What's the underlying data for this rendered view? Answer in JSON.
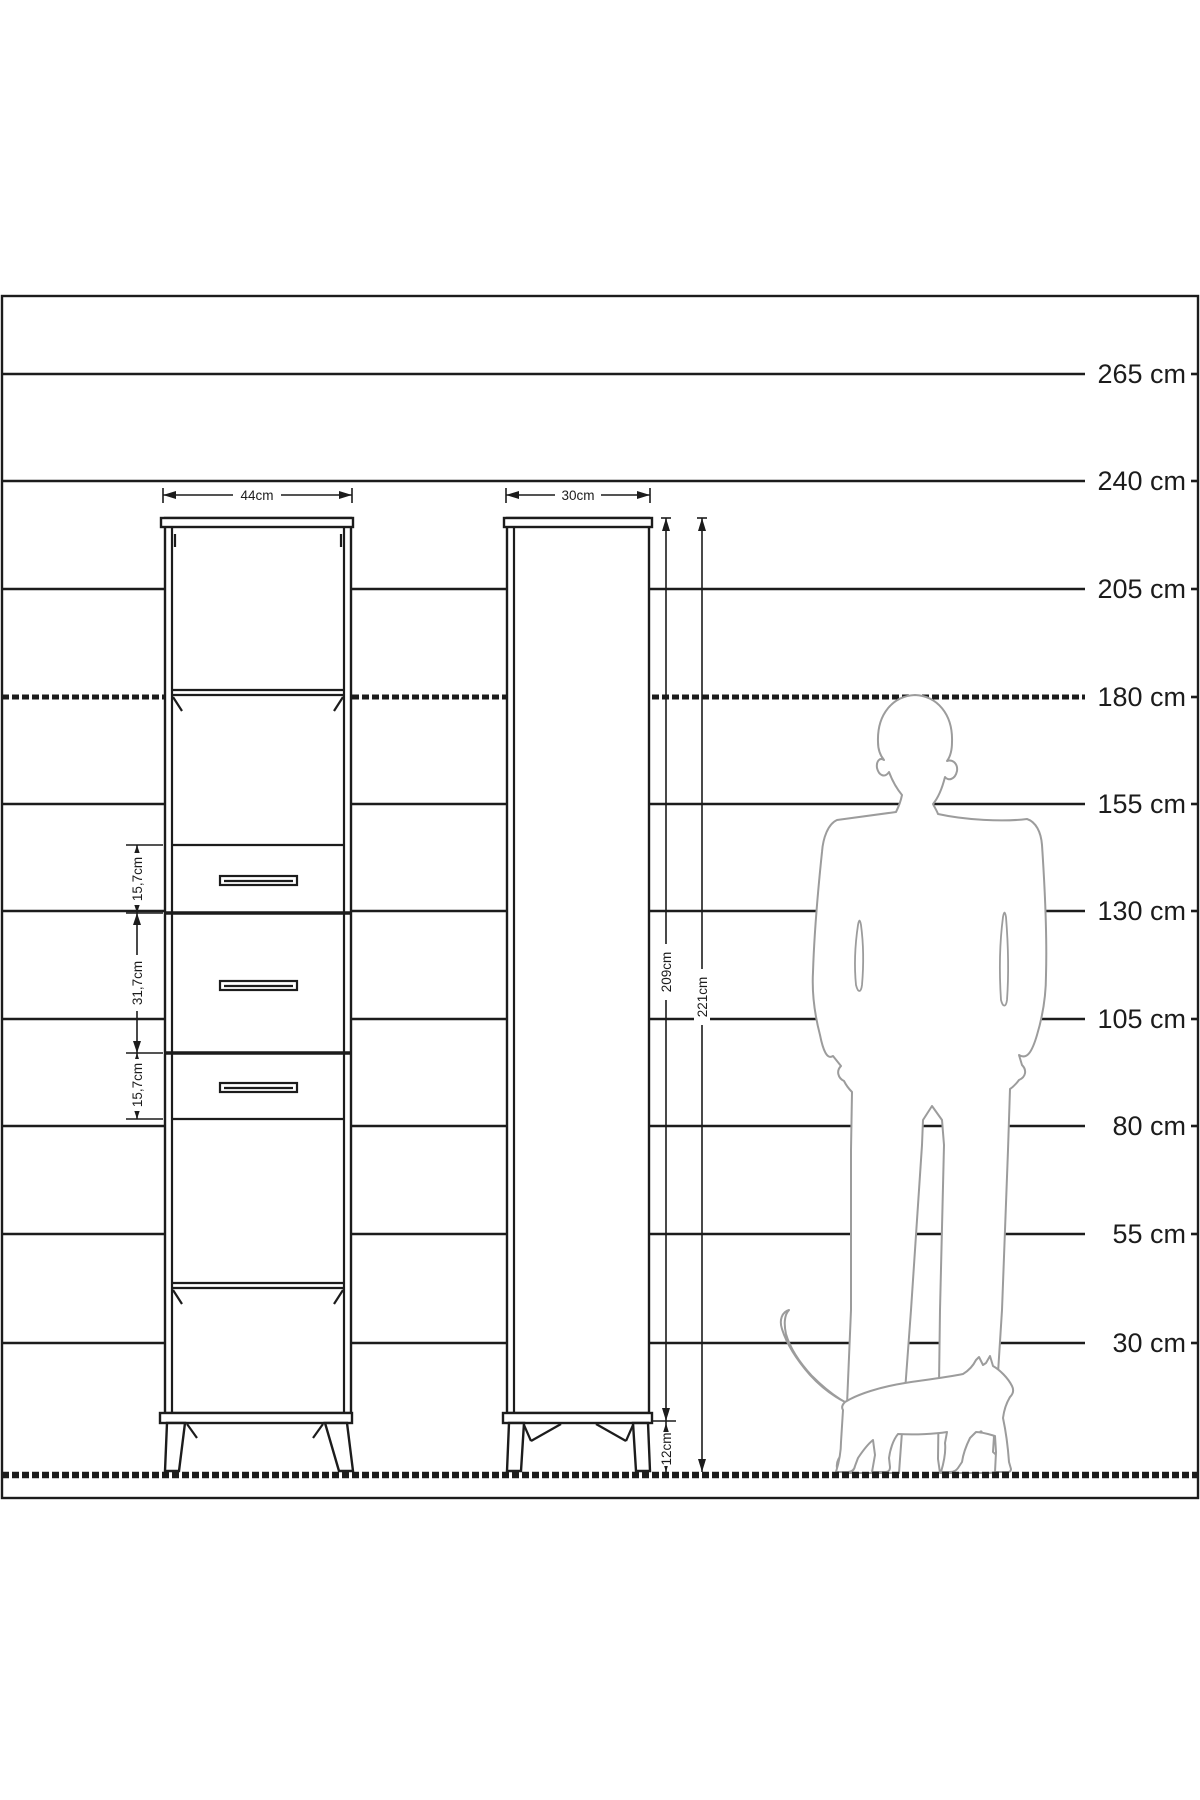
{
  "scale": {
    "labels": [
      "265 cm",
      "240 cm",
      "205 cm",
      "180 cm",
      "155 cm",
      "130 cm",
      "105 cm",
      "80 cm",
      "55 cm",
      "30 cm"
    ]
  },
  "front_view": {
    "width_label": "44cm",
    "drawer_dims": [
      "15,7cm",
      "31,7cm",
      "15,7cm"
    ]
  },
  "side_view": {
    "depth_label": "30cm",
    "body_height_label": "209cm",
    "total_height_label": "221cm",
    "leg_height_label": "12cm"
  },
  "colors": {
    "ink": "#1c1c1c",
    "silhouette": "#9c9c9c",
    "background": "#ffffff"
  }
}
